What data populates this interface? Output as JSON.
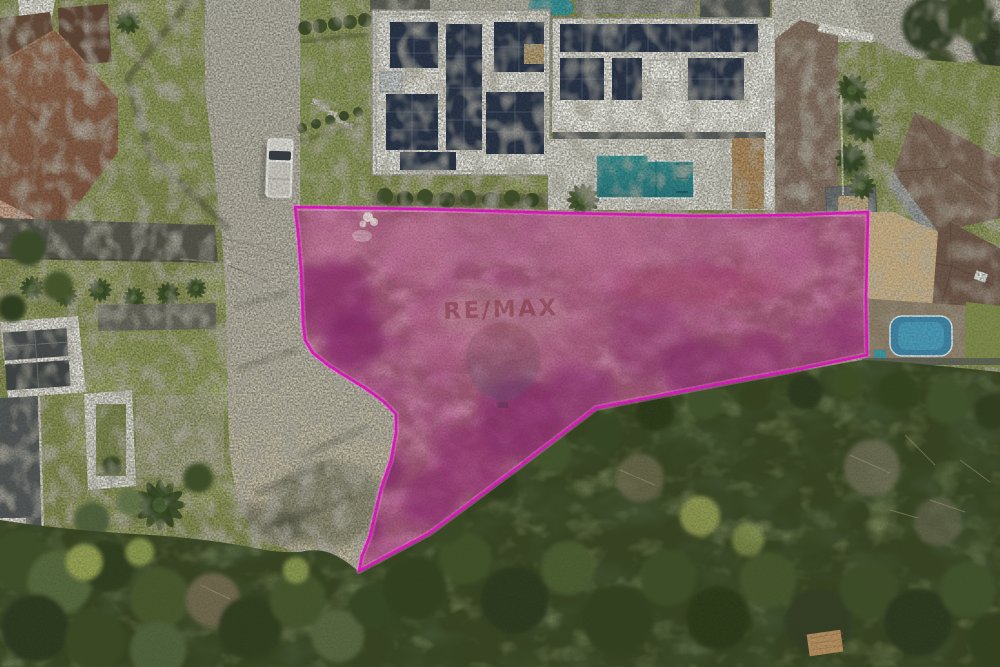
{
  "meta": {
    "kind": "aerial-drone-photograph",
    "subject": "residential land lot highlighted for sale, surrounded by houses, street and forest",
    "width_px": 1000,
    "height_px": 667
  },
  "watermark": {
    "brand": "RE/MAX",
    "text_color": "#8c3742",
    "balloon_top_color": "#96515b",
    "balloon_bottom_color": "#59597e",
    "opacity": "0.58"
  },
  "lot_highlight": {
    "stroke_color": "#ea12cb",
    "glow_color": "#ff8ae6",
    "fill_tint": "rgba(226,24,170,0.20)",
    "points": "295,207 420,209 560,213 700,216 800,215 868,212 866,300 867,355 790,371 725,383 596,408 520,466 430,533 359,571 362,556 370,536 381,489 391,460 396,433 396,414 383,401 365,388 347,377 328,365 313,353 305,340 303,322 301,270 298,232"
  },
  "colors": {
    "grass": "#87904f",
    "road": "#bab6ac",
    "road_tan": "#c9bfa4",
    "forest": "#36431f",
    "terracotta_roof": "#96604a",
    "dark_tile_roof": "#6e4b38",
    "modern_roof_white": "#e8e6e0",
    "solar_panel": "#212d49",
    "pool_teal": "#35a0a4",
    "pool_teal_deep": "#1f7c86",
    "garden_pool_blue": "#3d85a8",
    "wood_deck": "#b9905f",
    "driveway": "#8a7264",
    "truck": "#e9e9e6",
    "cobble_tan": "#c6ad84",
    "patio_stone": "#8d7f6a",
    "lot_ground": "#93656a"
  }
}
